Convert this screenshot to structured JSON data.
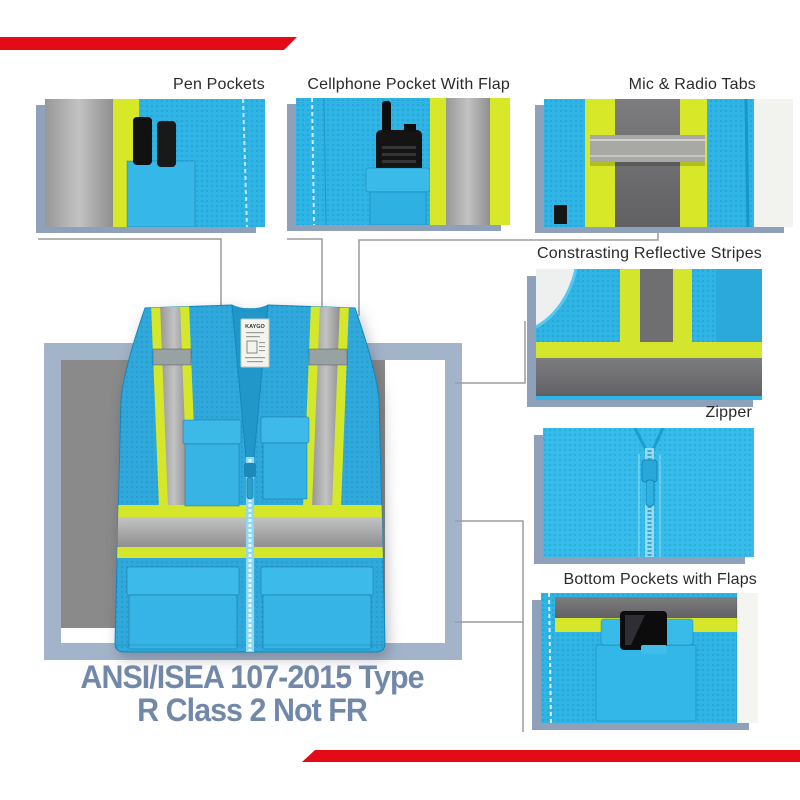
{
  "colors": {
    "banner_red": "#e30b17",
    "vest_blue": "#2fa9db",
    "thumb_blue": "#2fb4e6",
    "hi_vis_yellow": "#d5e72b",
    "reflective_silver": "#a9a9a9",
    "reflective_dark_gray": "#6f6f71",
    "backdrop_frame_blue": "#a3b4ca",
    "backdrop_inner_gray": "#8a8a8a",
    "thumb_shadow_blue": "#8fa0bb",
    "connector_line_gray": "#9b9b9b",
    "callout_text": "#2a2a2a",
    "compliance_text": "#7288a9"
  },
  "callouts": {
    "pen_pockets": {
      "label": "Pen Pockets"
    },
    "cellphone_pocket": {
      "label": "Cellphone Pocket With Flap"
    },
    "mic_radio_tabs": {
      "label": "Mic & Radio Tabs"
    },
    "reflective_stripes": {
      "label": "Constrasting Reflective Stripes"
    },
    "zipper": {
      "label": "Zipper"
    },
    "bottom_pockets": {
      "label": "Bottom Pockets with Flaps"
    }
  },
  "vest": {
    "brand_label": "KAYGO"
  },
  "compliance": {
    "line1": "ANSI/ISEA 107-2015 Type",
    "line2": "R Class 2 Not FR"
  }
}
